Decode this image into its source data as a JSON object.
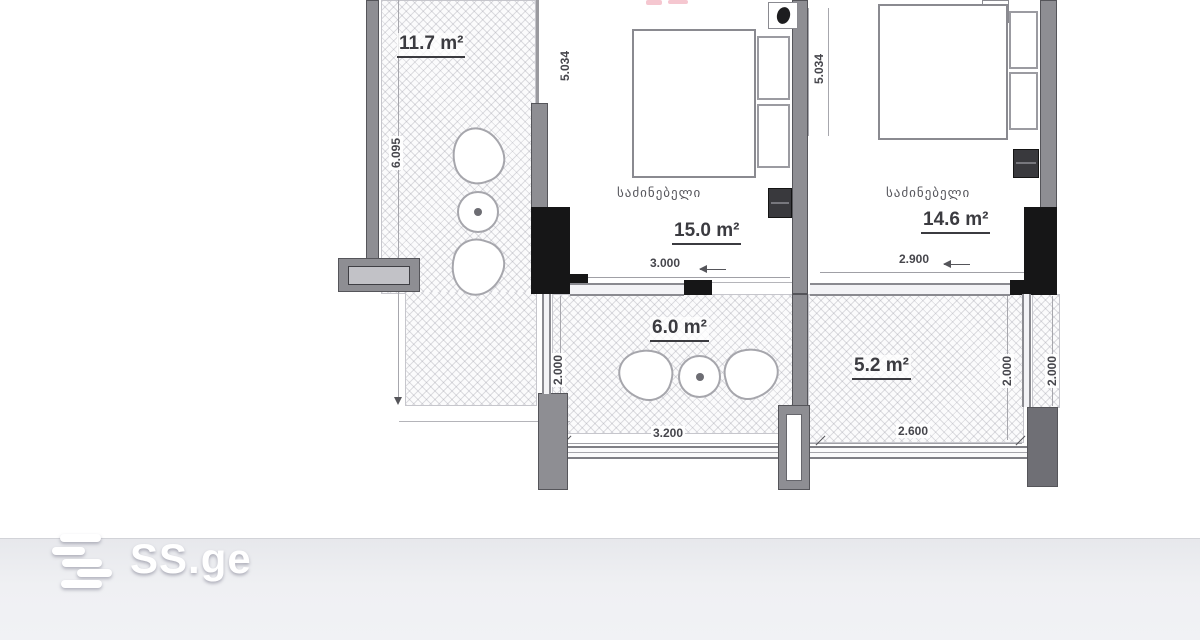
{
  "watermark": {
    "brand": "SS.ge"
  },
  "floorplan": {
    "rooms": {
      "balcony_top": {
        "area": "11.7 m²"
      },
      "bedroom_1": {
        "name": "საძინებელი",
        "area": "15.0 m²"
      },
      "bedroom_2": {
        "name": "საძინებელი",
        "area": "14.6 m²"
      },
      "balcony_mid": {
        "area": "6.0 m²"
      },
      "balcony_right": {
        "area": "5.2 m²"
      }
    },
    "dimensions": {
      "left_height": "6.095",
      "bedroom1_height": "5.034",
      "bedroom2_height": "5.034",
      "bedroom1_width": "3.000",
      "bedroom2_width": "2.900",
      "balcony_mid_height": "2.000",
      "balcony_mid_width": "3.200",
      "balcony_right_width": "2.600",
      "balcony_right_height": "2.000",
      "right_edge_height": "2.000"
    },
    "colors": {
      "wall_gray": "#8e8e93",
      "wall_black": "#161617",
      "footer_bg": "#eff0f3",
      "logo": "#ffffff"
    }
  }
}
